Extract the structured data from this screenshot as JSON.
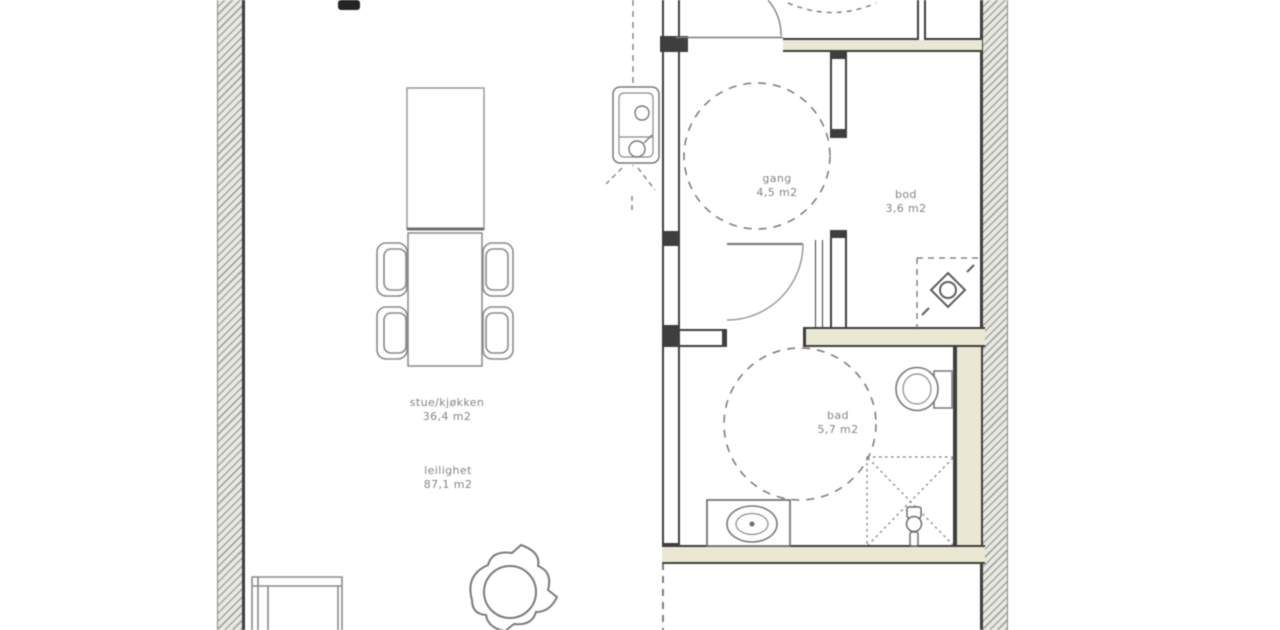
{
  "labels": {
    "stue": {
      "name": "stue/kjøkken",
      "area": "36,4 m2"
    },
    "leilighet": {
      "name": "leilighet",
      "area": "87,1 m2"
    },
    "gang": {
      "name": "gang",
      "area": "4,5 m2"
    },
    "bod": {
      "name": "bod",
      "area": "3,6 m2"
    },
    "bad": {
      "name": "bad",
      "area": "5,7 m2"
    }
  },
  "colors": {
    "wall_dark": "#3e3e3e",
    "wet_room_wall_fill": "#eae7d2",
    "exterior_wall_fill": "#e9e9e4",
    "line_gray": "#707070",
    "label_gray": "#848484"
  }
}
